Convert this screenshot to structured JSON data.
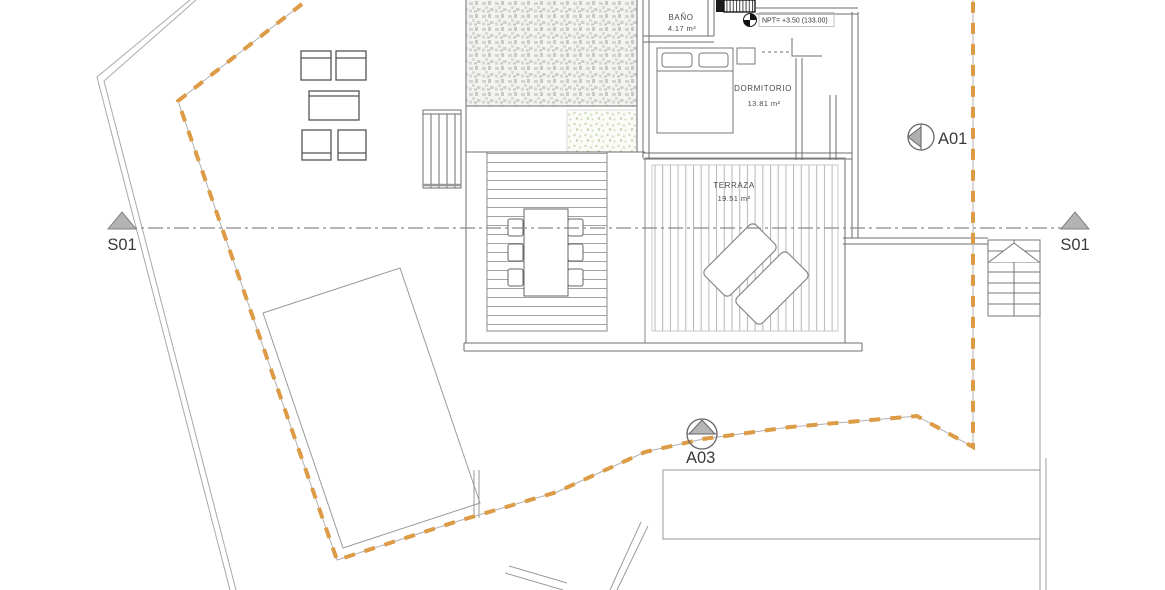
{
  "plan": {
    "rooms": {
      "bano": {
        "name": "BAÑO",
        "area": "4.17 m²"
      },
      "dormitorio": {
        "name": "DORMITORIO",
        "area": "13.81 m²"
      },
      "terraza": {
        "name": "TERRAZA",
        "area": "19.51 m²"
      }
    },
    "level_marker": {
      "text": "NPT= +3.50 (133.00)"
    },
    "markers": {
      "section_left": {
        "label": "S01"
      },
      "section_right": {
        "label": "S01"
      },
      "a01": {
        "label": "A01"
      },
      "a03": {
        "label": "A03"
      }
    },
    "colors": {
      "plot_boundary_orange": "#DD9B45",
      "drawing_line_gray": "#6E6E6E",
      "marker_fill_gray": "#B3B3B3"
    }
  }
}
